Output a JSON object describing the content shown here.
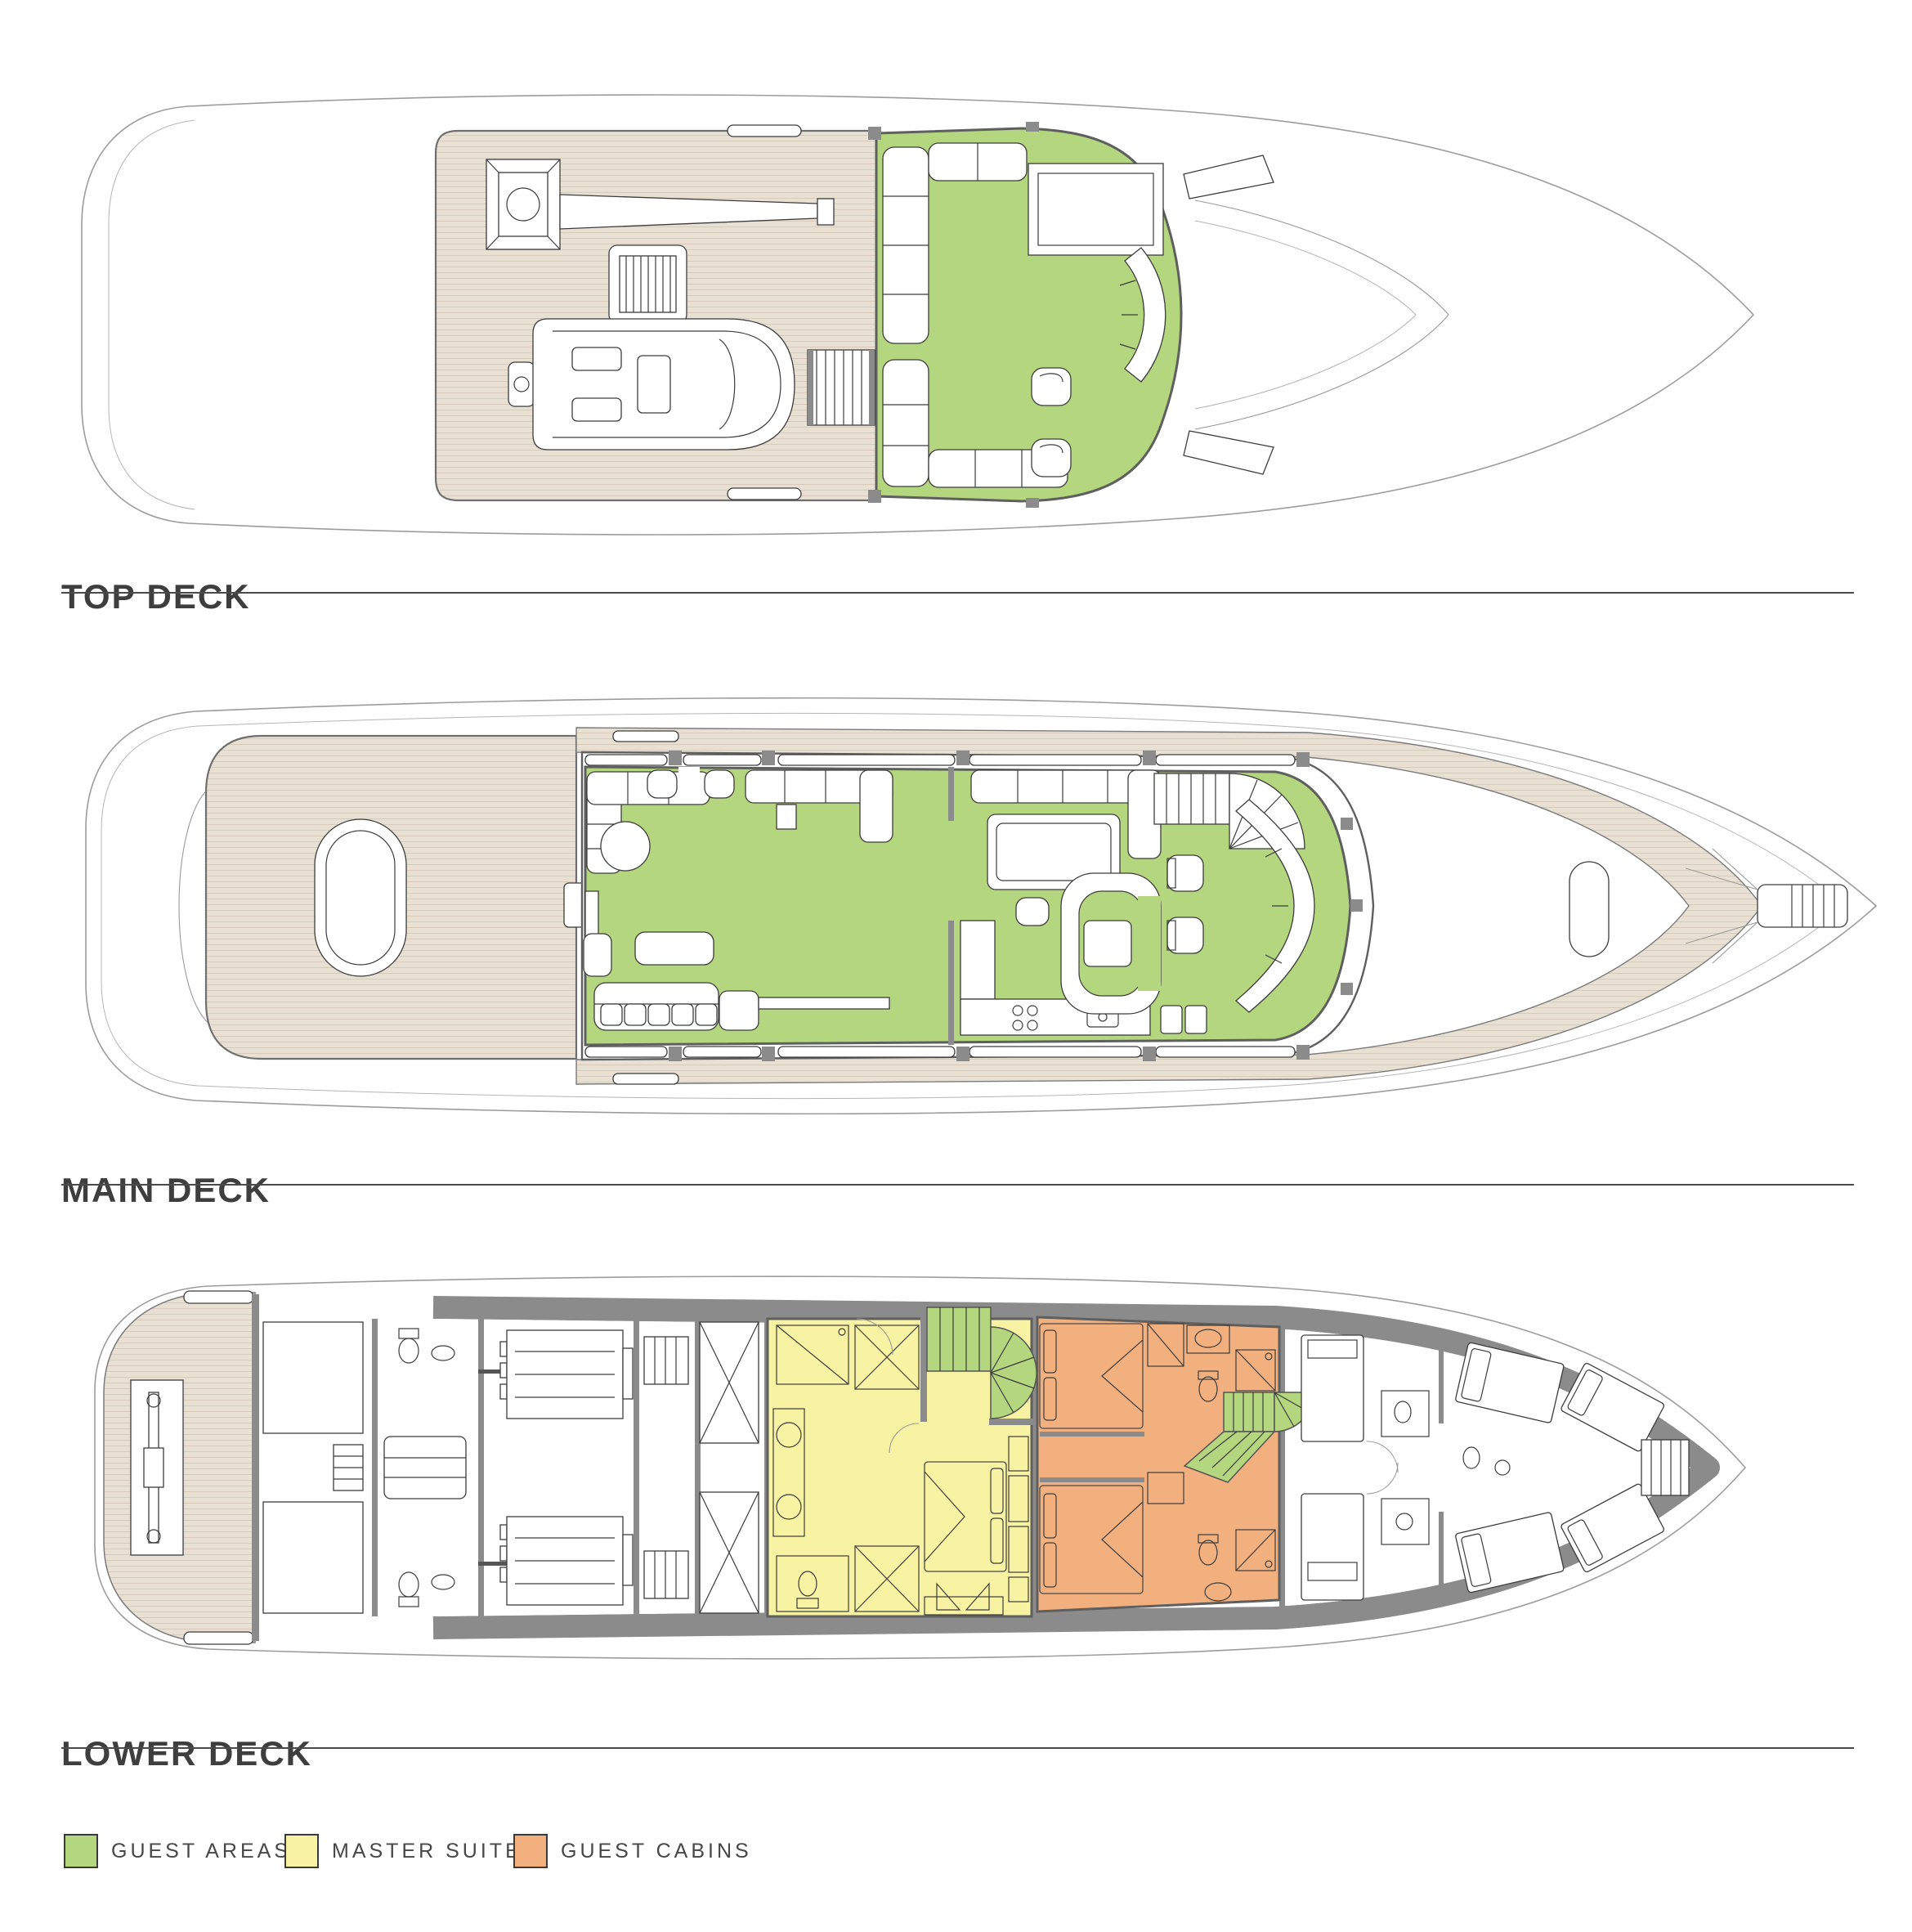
{
  "decks": [
    {
      "id": "top-deck",
      "label": "TOP DECK"
    },
    {
      "id": "main-deck",
      "label": "MAIN DECK"
    },
    {
      "id": "lower-deck",
      "label": "LOWER DECK"
    }
  ],
  "legend": {
    "items": [
      {
        "id": "guest-areas",
        "label": "GUEST AREAS",
        "color": "#b3d67e"
      },
      {
        "id": "master-suite",
        "label": "MASTER SUITE",
        "color": "#f8f3a2"
      },
      {
        "id": "guest-cabins",
        "label": "GUEST CABINS",
        "color": "#f3b07f"
      }
    ]
  },
  "theme": {
    "green": "#b3d67e",
    "yellow": "#f8f3a2",
    "orange": "#f3b07f",
    "teak": "#e9e0d4",
    "teak_line": "#d8cbbc",
    "wall": "#8b8b8b",
    "outline": "#9c9c9c",
    "ink": "#3e3e3e",
    "rule": "#4a4a4a",
    "text": "#474747"
  }
}
